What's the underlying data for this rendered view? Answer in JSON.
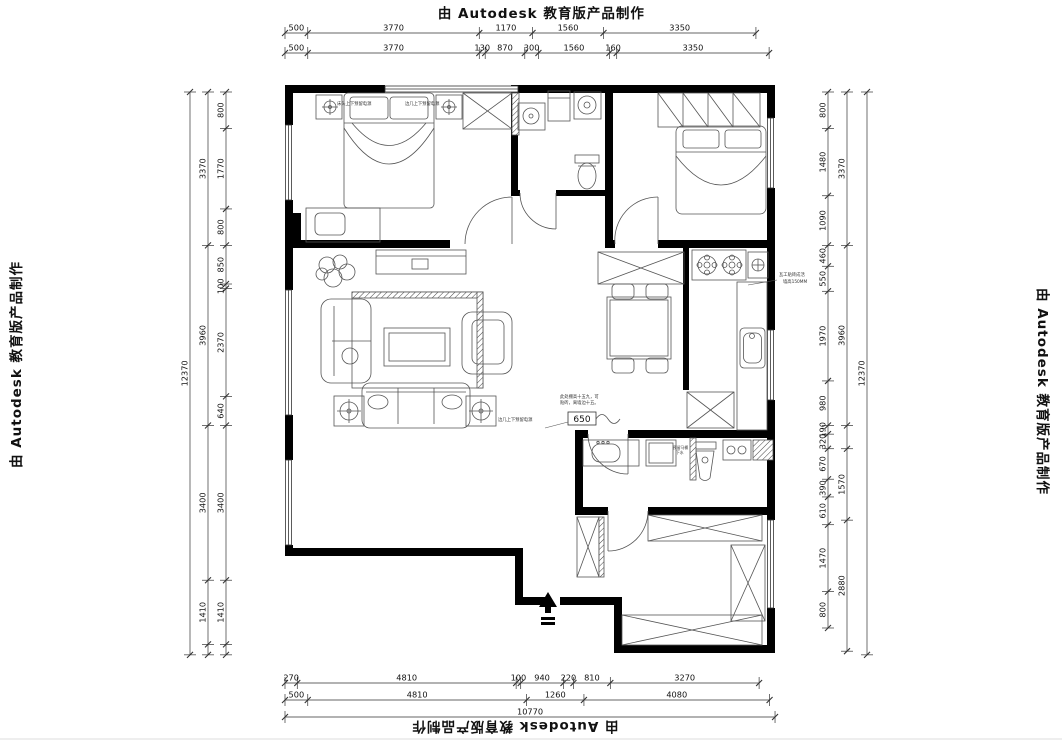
{
  "watermark": {
    "text": "由 Autodesk 教育版产品制作"
  },
  "annotations": {
    "bed_left_outlet": "床头上下预留电源",
    "bed_right_outlet": "边几上下预留电源",
    "sofa_outlet": "边几上下预留电源",
    "ceiling_note_line1": "此处棚高十五九，可",
    "ceiling_note_line2": "贴砖，离墙边十五。",
    "ceiling_dim": "650",
    "kitchen_note_line1": "瓦工贴砖成活",
    "kitchen_note_line2": "墙高150MM",
    "toilet_note_line1": "预留马桶",
    "toilet_note_line2": "下水"
  },
  "chart_data": {
    "type": "floorplan-dimensions",
    "units": "mm",
    "overall": {
      "width": "10770",
      "height": "12370"
    },
    "chains": [
      {
        "name": "top-row-1",
        "o": "h",
        "x": 285,
        "y": 33,
        "segs": [
          {
            "mm": 500,
            "t": "500"
          },
          {
            "mm": 3770,
            "t": "3770"
          },
          {
            "mm": 1170,
            "t": "1170"
          },
          {
            "mm": 1560,
            "t": "1560"
          },
          {
            "mm": 3350,
            "t": "3350"
          }
        ]
      },
      {
        "name": "top-row-2",
        "o": "h",
        "x": 285,
        "y": 53,
        "segs": [
          {
            "mm": 500,
            "t": "500"
          },
          {
            "mm": 3770,
            "t": "3770"
          },
          {
            "mm": 130,
            "t": "130"
          },
          {
            "mm": 870,
            "t": "870"
          },
          {
            "mm": 300,
            "t": "300"
          },
          {
            "mm": 1560,
            "t": "1560"
          },
          {
            "mm": 160,
            "t": "160"
          },
          {
            "mm": 3350,
            "t": "3350"
          }
        ]
      },
      {
        "name": "bottom-row-1",
        "o": "h",
        "x": 285,
        "y": 683,
        "segs": [
          {
            "mm": 270,
            "t": "270"
          },
          {
            "mm": 4810,
            "t": "4810"
          },
          {
            "mm": 100,
            "t": "100"
          },
          {
            "mm": 940,
            "t": "940"
          },
          {
            "mm": 220,
            "t": "220"
          },
          {
            "mm": 810,
            "t": "810"
          },
          {
            "mm": 3270,
            "t": "3270"
          }
        ]
      },
      {
        "name": "bottom-row-2",
        "o": "h",
        "x": 285,
        "y": 700,
        "segs": [
          {
            "mm": 500,
            "t": "500"
          },
          {
            "mm": 4810,
            "t": "4810"
          },
          {
            "mm": 1260,
            "t": "1260"
          },
          {
            "mm": 4080,
            "t": "4080"
          }
        ]
      },
      {
        "name": "bottom-row-3",
        "o": "h",
        "x": 285,
        "y": 717,
        "segs": [
          {
            "mm": 10770,
            "t": "10770"
          }
        ]
      },
      {
        "name": "left-outer",
        "o": "v",
        "x": 190,
        "y": 92,
        "segs": [
          {
            "mm": 12370,
            "t": "12370"
          }
        ]
      },
      {
        "name": "left-middle",
        "o": "v",
        "x": 208,
        "y": 92,
        "segs": [
          {
            "mm": 3370,
            "t": "3370"
          },
          {
            "mm": 3960,
            "t": "3960"
          },
          {
            "mm": 3400,
            "t": "3400"
          },
          {
            "mm": 1410,
            "t": "1410"
          },
          {
            "mm": 230,
            "t": ""
          }
        ]
      },
      {
        "name": "left-inner",
        "o": "v",
        "x": 226,
        "y": 92,
        "segs": [
          {
            "mm": 800,
            "t": "800"
          },
          {
            "mm": 1770,
            "t": "1770"
          },
          {
            "mm": 800,
            "t": "800"
          },
          {
            "mm": 850,
            "t": "850"
          },
          {
            "mm": 100,
            "t": "100"
          },
          {
            "mm": 2370,
            "t": "2370"
          },
          {
            "mm": 640,
            "t": "640"
          },
          {
            "mm": 3400,
            "t": "3400"
          },
          {
            "mm": 1410,
            "t": "1410"
          },
          {
            "mm": 230,
            "t": ""
          }
        ]
      },
      {
        "name": "right-inner",
        "o": "v",
        "x": 828,
        "y": 92,
        "segs": [
          {
            "mm": 800,
            "t": "800"
          },
          {
            "mm": 1480,
            "t": "1480"
          },
          {
            "mm": 1090,
            "t": "1090"
          },
          {
            "mm": 460,
            "t": "460"
          },
          {
            "mm": 550,
            "t": "550"
          },
          {
            "mm": 1970,
            "t": "1970"
          },
          {
            "mm": 980,
            "t": "980"
          },
          {
            "mm": 190,
            "t": "190"
          },
          {
            "mm": 320,
            "t": "320"
          },
          {
            "mm": 670,
            "t": "670"
          },
          {
            "mm": 390,
            "t": "390"
          },
          {
            "mm": 610,
            "t": "610"
          },
          {
            "mm": 1470,
            "t": "1470"
          },
          {
            "mm": 800,
            "t": "800"
          }
        ]
      },
      {
        "name": "right-middle",
        "o": "v",
        "x": 847,
        "y": 92,
        "segs": [
          {
            "mm": 3370,
            "t": "3370"
          },
          {
            "mm": 3960,
            "t": "3960"
          },
          {
            "mm": 510,
            "t": ""
          },
          {
            "mm": 1570,
            "t": "1570"
          },
          {
            "mm": 2880,
            "t": "2880"
          }
        ]
      },
      {
        "name": "right-outer",
        "o": "v",
        "x": 867,
        "y": 92,
        "segs": [
          {
            "mm": 12370,
            "t": "12370"
          }
        ]
      }
    ]
  }
}
